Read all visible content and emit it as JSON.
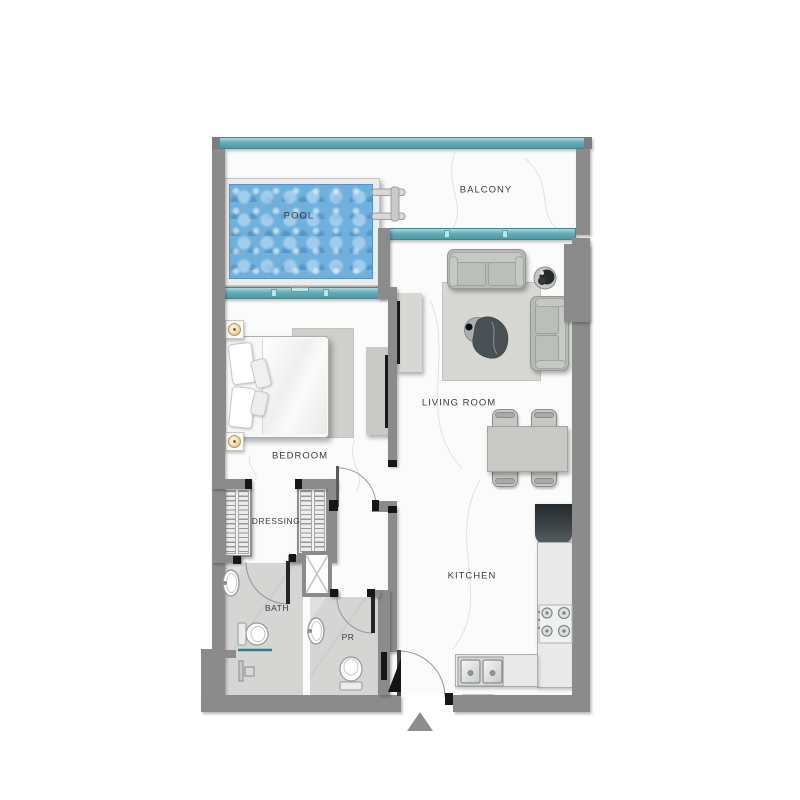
{
  "labels": {
    "balcony": "BALCONY",
    "pool": "POOL",
    "living_room": "LIVING ROOM",
    "bedroom": "BEDROOM",
    "dressing": "DRESSING",
    "bath": "BATH",
    "pr": "PR",
    "kitchen": "KITCHEN"
  },
  "icons": [
    "entrance-arrow-icon",
    "pool-ladder-icon",
    "door-swing-icon",
    "shaft-cross-icon",
    "shower-icon",
    "bath-sink-icon",
    "bath-toilet-icon",
    "pr-sink-icon",
    "pr-toilet-icon",
    "cooktop-icon",
    "kitchen-sink-icon",
    "plant-icon",
    "floor-lamp-icon",
    "tv-icon",
    "coffee-table-icon"
  ],
  "colors": {
    "wall": "#8b8b8b",
    "wall_dark": "#6f6f6f",
    "ink": "#1b1b1b",
    "glass": "#63aab4",
    "glass_light": "#a9d9df",
    "glass_border": "#44848e",
    "water": "#6fb0dd",
    "water_border": "#5892c4",
    "deck": "#ececec",
    "floor": "#fbfbfb",
    "tile": "#d5d5d3",
    "label": "#3b3b3b",
    "sofa": "#b6bab4",
    "rug": "#d7d7d4",
    "counter": "#e9e9e9",
    "fridge_dark": "#24292c",
    "arrow": "#8d8d8d"
  }
}
